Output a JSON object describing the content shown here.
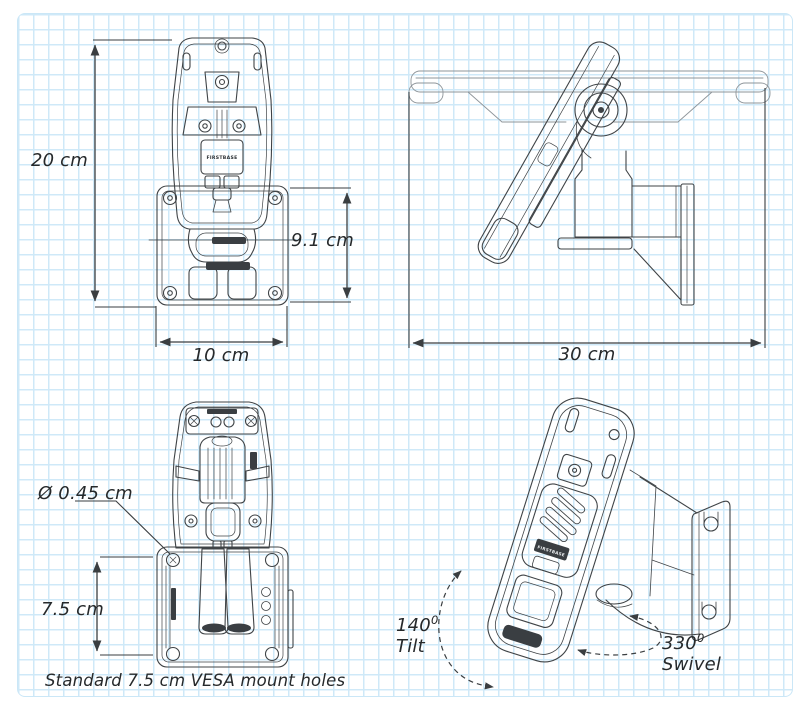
{
  "diagram": {
    "brand": "FIRSTBASE",
    "dimensions": {
      "height": "20 cm",
      "bracket_height": "9.1 cm",
      "width": "10 cm",
      "depth": "30 cm",
      "hole_diameter": "Ø 0.45 cm",
      "hole_spacing": "7.5 cm"
    },
    "caption": "Standard 7.5 cm VESA mount holes",
    "tilt": {
      "value": "140",
      "sup": "0",
      "word": "Tilt"
    },
    "swivel": {
      "value": "330",
      "sup": "0",
      "word": "Swivel"
    }
  }
}
